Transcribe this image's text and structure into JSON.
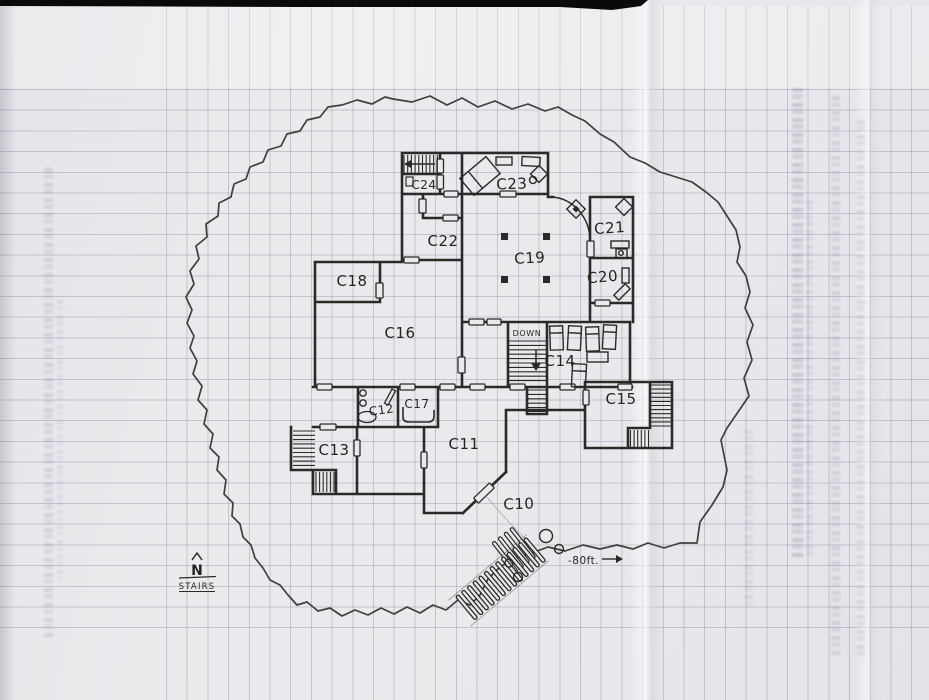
{
  "map": {
    "rooms": [
      {
        "label": "C10"
      },
      {
        "label": "C11"
      },
      {
        "label": "C12"
      },
      {
        "label": "C13"
      },
      {
        "label": "C14"
      },
      {
        "label": "C15"
      },
      {
        "label": "C16"
      },
      {
        "label": "C17"
      },
      {
        "label": "C18"
      },
      {
        "label": "C19"
      },
      {
        "label": "C20"
      },
      {
        "label": "C21"
      },
      {
        "label": "C22"
      },
      {
        "label": "C23"
      },
      {
        "label": "C24"
      }
    ],
    "stairwell": {
      "down_label": "DOWN"
    },
    "scale_marker": {
      "label": "-80ft."
    },
    "compass": {
      "north_label": "N",
      "stairs_label": "STAIRS"
    },
    "colors": {
      "paper": "#e9e9ed",
      "grid_line": "#aeb2c4",
      "ink": "#2b2a26",
      "scan_bar": "#0a0a0a"
    }
  }
}
